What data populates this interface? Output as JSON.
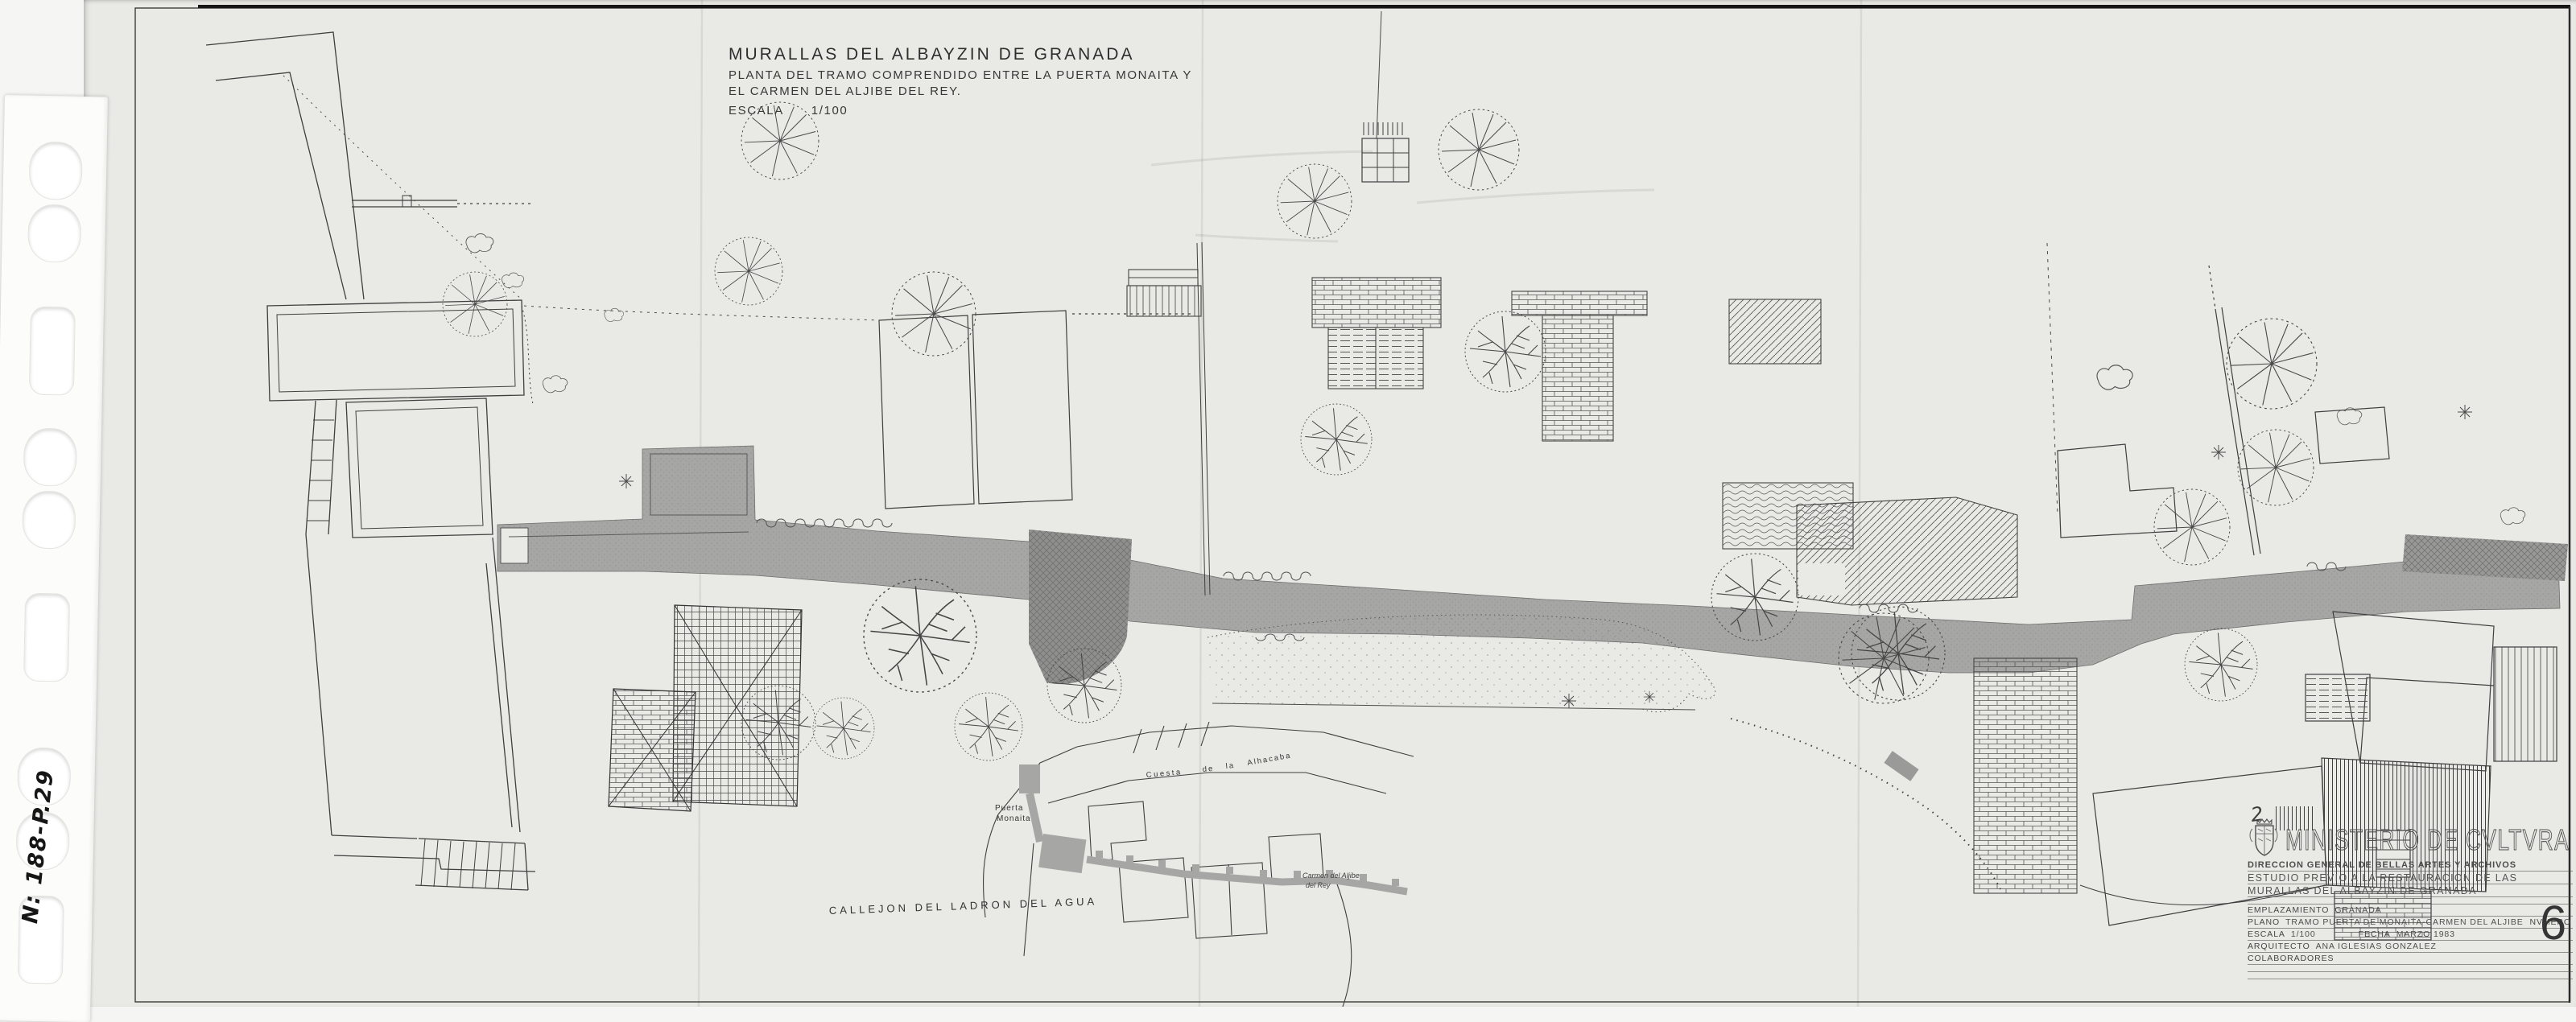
{
  "document": {
    "kind": "scanned architectural site plan",
    "catalog_number": "N: 188-P.29",
    "title_block_top": {
      "line1": "MURALLAS DEL ALBAYZIN DE GRANADA",
      "line2": "PLANTA DEL TRAMO COMPRENDIDO ENTRE LA PUERTA MONAITA Y",
      "line3": "EL CARMEN DEL ALJIBE DEL REY.",
      "scale_label": "ESCALA",
      "scale_value": "1/100"
    },
    "plan_labels": {
      "street_bottom": "CALLEJON DEL LADRON DEL AGUA",
      "cuesta_word1": "Cuesta",
      "cuesta_word2": "de",
      "cuesta_word3": "la",
      "cuesta_word4": "Alhacaba",
      "puerta_line1": "Puerta",
      "puerta_line2": "Monaita",
      "carmen_line1": "Carmen del Aljibe",
      "carmen_line2": "del Rey"
    },
    "stamp_block": {
      "handwritten_mark": "2",
      "ministry": "MINISTERIO DE CVLTVRA",
      "direccion": "DIRECCION GENERAL DE BELLAS ARTES Y ARCHIVOS",
      "estudio_line1": "ESTUDIO PREVIO A LA RESTAURACION DE LAS",
      "estudio_line2": "MURALLAS DEL ALBAYZIN DE GRANADA",
      "emplazamiento_label": "EMPLAZAMIENTO",
      "emplazamiento_value": "GRANADA",
      "plano_label": "PLANO",
      "plano_value": "TRAMO PUERTA DE MONAITA-CARMEN DEL ALJIBE",
      "numero_label": "NVMERO",
      "escala_label": "ESCALA",
      "escala_value": "1/100",
      "fecha_label": "FECHA",
      "fecha_value": "MARZO 1983",
      "arquitecto_label": "ARQUITECTO",
      "arquitecto_value": "ANA IGLESIAS GONZALEZ",
      "colaboradores_label": "COLABORADORES",
      "sheet_number": "6"
    },
    "icons": {
      "coat_of_arms": "spanish heraldic crest above ministry name",
      "punch_hole": "oval filing punch holes on binder strip"
    }
  },
  "colors": {
    "background": "#f5f5f3",
    "paper": "#e9e9e6",
    "strip_white": "#fcfcfa",
    "ink": "#3a3a3a",
    "wall_gray": "#a6a6a4",
    "wall_dark": "#8f8f8d"
  }
}
